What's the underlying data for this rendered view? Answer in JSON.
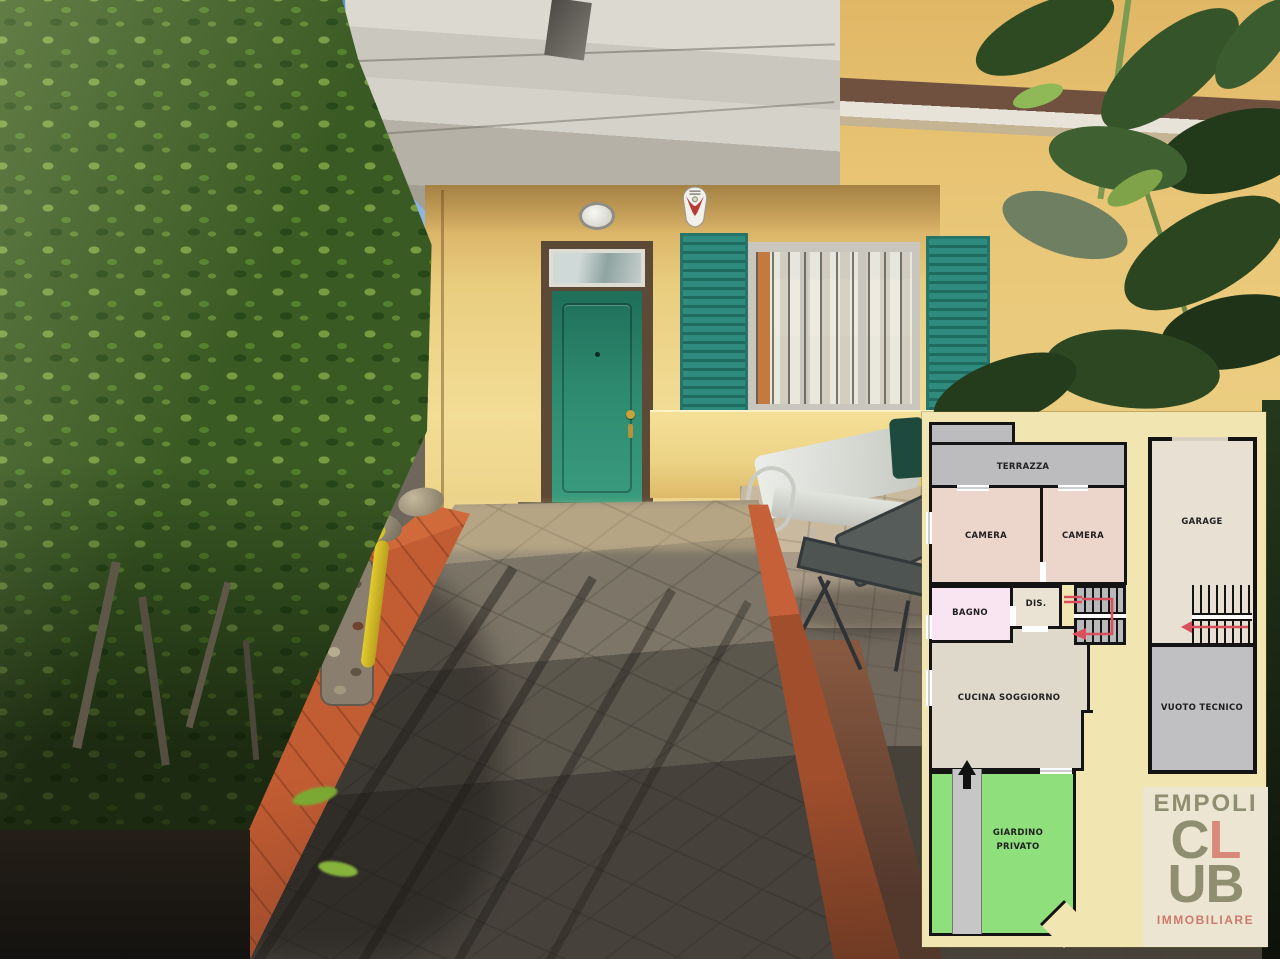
{
  "scene_description": "house entrance photo with floor plan overlay",
  "floor_plan": {
    "rooms": {
      "terrazza": "TERRAZZA",
      "camera_left": "CAMERA",
      "camera_right": "CAMERA",
      "bagno": "BAGNO",
      "dis": "DIS.",
      "cucina_soggiorno": "CUCINA SOGGIORNO",
      "giardino_line1": "GIARDINO",
      "giardino_line2": "PRIVATO",
      "garage": "GARAGE",
      "vuoto_tecnico": "VUOTO TECNICO"
    },
    "colors": {
      "background": "#f1e6b2",
      "wall": "#141414",
      "terrazza": "#bcbcbe",
      "camera": "#ecd5cb",
      "bagno": "#f9e4f1",
      "dis": "#eae3d3",
      "stairs": "#b9b9bb",
      "cucina": "#dfd9cc",
      "giardino": "#8fe07d",
      "walkway": "#c6c6c6",
      "garage": "#e7e0d3",
      "vuoto": "#c0c0c2",
      "arrow_red": "#d94f5c",
      "entrance_arrow": "#111111"
    }
  },
  "logo": {
    "word_top": "EMPOLI",
    "letters": [
      "C",
      "L",
      "U",
      "B"
    ],
    "word_bottom": "IMMOBILIARE",
    "colors": {
      "bg": "#ebe5d1",
      "olive": "#8f8e71",
      "salmon": "#d8897a"
    }
  },
  "photo": {
    "colors": {
      "sky": "#7aa6d8",
      "house_wall": "#e9cd7f",
      "front_door": "#2e8a6e",
      "shutters": "#2f8b7e",
      "terracotta_edge": "#c25c32",
      "hedge_green": "#3a5a24",
      "path_stone": "#6f675c"
    }
  }
}
